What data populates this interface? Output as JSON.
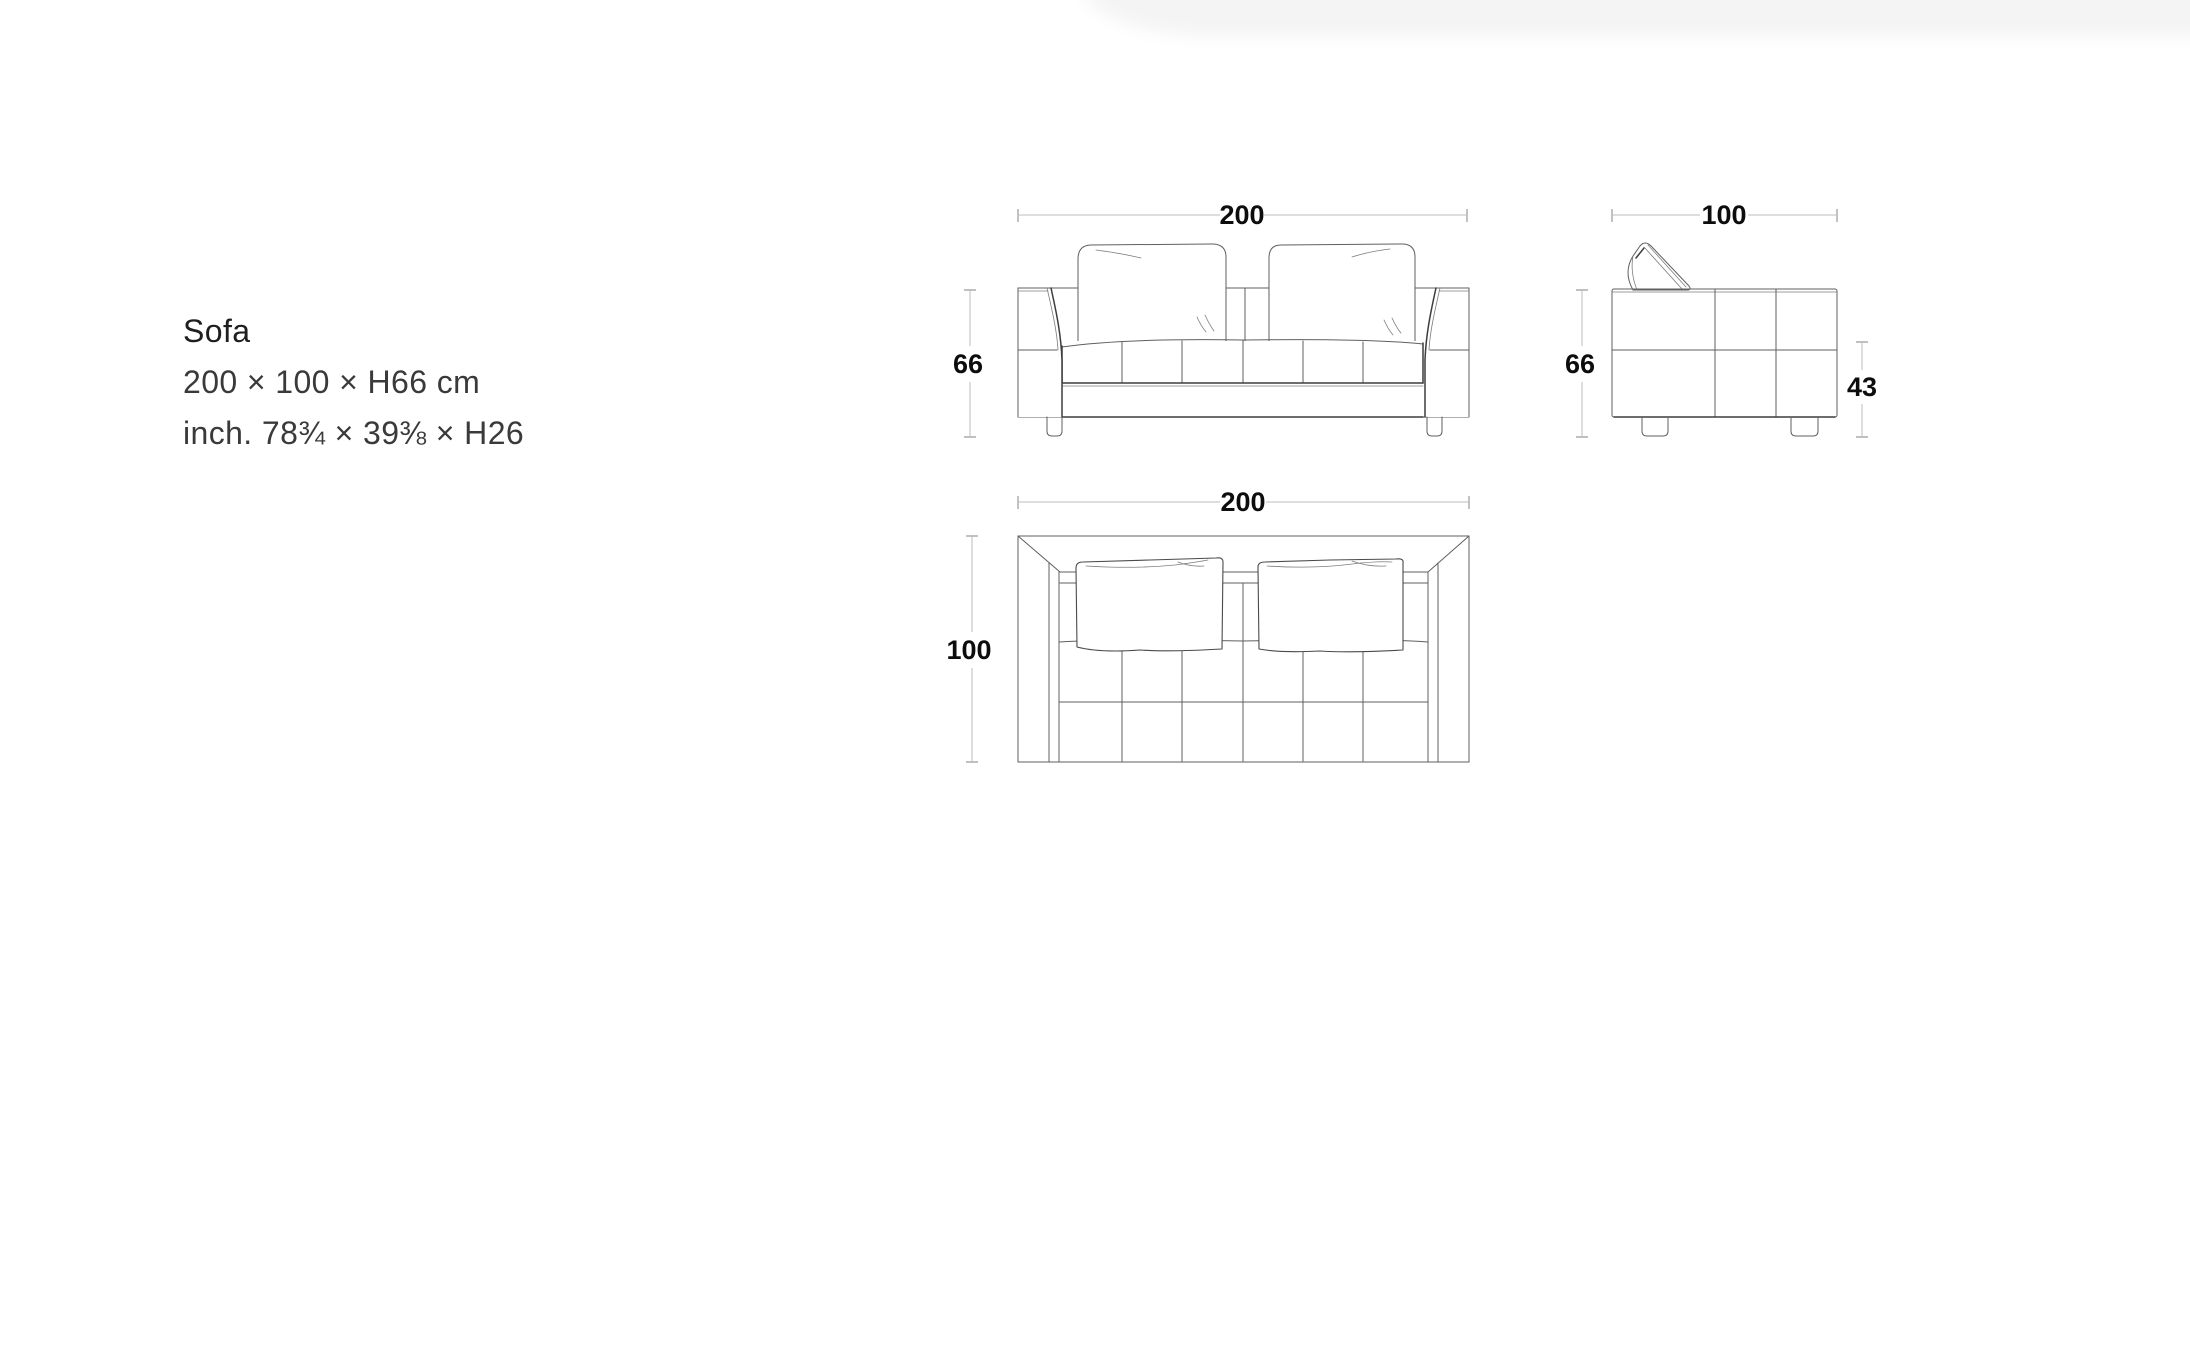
{
  "page": {
    "background_color": "#ffffff"
  },
  "product": {
    "name": "Sofa",
    "dimensions_cm": "200 × 100 × H66 cm",
    "dimensions_inch": "inch. 78¾ × 39⅜ × H26"
  },
  "drawing": {
    "front_view": {
      "width_cm": "200",
      "height_cm": "66"
    },
    "side_view": {
      "depth_cm": "100",
      "height_cm": "66",
      "seat_height_cm": "43"
    },
    "top_view": {
      "width_cm": "200",
      "depth_cm": "100"
    }
  },
  "colors": {
    "drawing_line": "#5f5f5f",
    "dimension_line": "#bcbcbc",
    "dimension_text": "#0d0d0d",
    "body_text": "#3a3a3a"
  }
}
